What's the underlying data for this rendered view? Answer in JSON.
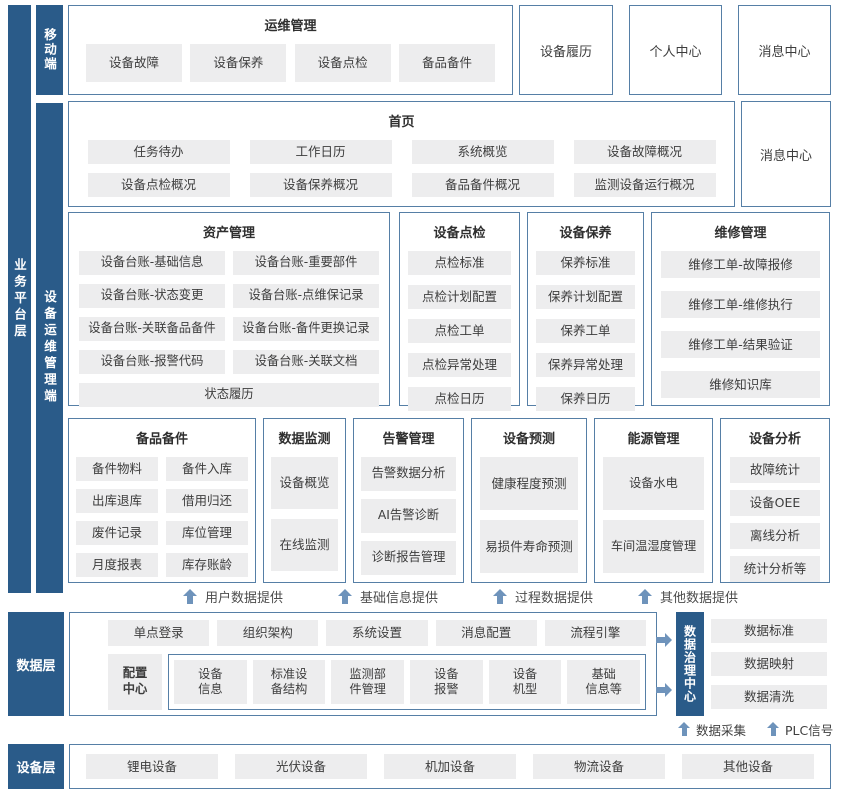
{
  "bars": {
    "business": "业务平台层",
    "mobile": "移动端",
    "device_om": "设备运维管理端",
    "data": "数据层",
    "base_support": "基础支撑",
    "device": "设备层",
    "governance": "数据治理中心"
  },
  "mobile_section": {
    "title": "运维管理",
    "items": [
      "设备故障",
      "设备保养",
      "设备点检",
      "备品备件"
    ],
    "boxes": [
      "设备履历",
      "个人中心",
      "消息中心"
    ]
  },
  "home_section": {
    "title": "首页",
    "items": [
      "任务待办",
      "工作日历",
      "系统概览",
      "设备故障概况",
      "设备点检概况",
      "设备保养概况",
      "备品备件概况",
      "监测设备运行概况"
    ],
    "side_box": "消息中心"
  },
  "modules_row1": [
    {
      "title": "资产管理",
      "items": [
        "设备台账-基础信息",
        "设备台账-重要部件",
        "设备台账-状态变更",
        "设备台账-点维保记录",
        "设备台账-关联备品备件",
        "设备台账-备件更换记录",
        "设备台账-报警代码",
        "设备台账-关联文档",
        "状态履历"
      ]
    },
    {
      "title": "设备点检",
      "items": [
        "点检标准",
        "点检计划配置",
        "点检工单",
        "点检异常处理",
        "点检日历"
      ]
    },
    {
      "title": "设备保养",
      "items": [
        "保养标准",
        "保养计划配置",
        "保养工单",
        "保养异常处理",
        "保养日历"
      ]
    },
    {
      "title": "维修管理",
      "items": [
        "维修工单-故障报修",
        "维修工单-维修执行",
        "维修工单-结果验证",
        "维修知识库"
      ]
    }
  ],
  "modules_row2": [
    {
      "title": "备品备件",
      "items": [
        "备件物料",
        "备件入库",
        "出库退库",
        "借用归还",
        "废件记录",
        "库位管理",
        "月度报表",
        "库存账龄"
      ]
    },
    {
      "title": "数据监测",
      "items": [
        "设备概览",
        "在线监测"
      ]
    },
    {
      "title": "告警管理",
      "items": [
        "告警数据分析",
        "AI告警诊断",
        "诊断报告管理"
      ]
    },
    {
      "title": "设备预测",
      "items": [
        "健康程度预测",
        "易损件寿命预测"
      ]
    },
    {
      "title": "能源管理",
      "items": [
        "设备水电",
        "车间温湿度管理"
      ]
    },
    {
      "title": "设备分析",
      "items": [
        "故障统计",
        "设备OEE",
        "离线分析",
        "统计分析等"
      ]
    }
  ],
  "flow_labels": [
    "用户数据提供",
    "基础信息提供",
    "过程数据提供",
    "其他数据提供"
  ],
  "data_section": {
    "row1": [
      "单点登录",
      "组织架构",
      "系统设置",
      "消息配置",
      "流程引擎"
    ],
    "config_center": "配置\n中心",
    "row2": [
      "设备\n信息",
      "标准设\n备结构",
      "监测部\n件管理",
      "设备\n报警",
      "设备\n机型",
      "基础\n信息等"
    ],
    "governance_items": [
      "数据标准",
      "数据映射",
      "数据清洗"
    ],
    "collect_label": "数据采集",
    "plc_label": "PLC信号"
  },
  "device_section": {
    "items": [
      "锂电设备",
      "光伏设备",
      "机加设备",
      "物流设备",
      "其他设备"
    ]
  },
  "colors": {
    "bar_blue": "#2a5b89",
    "border_blue": "#567fa6",
    "item_gray": "#ededee",
    "arrow_blue": "#6e93bb"
  }
}
